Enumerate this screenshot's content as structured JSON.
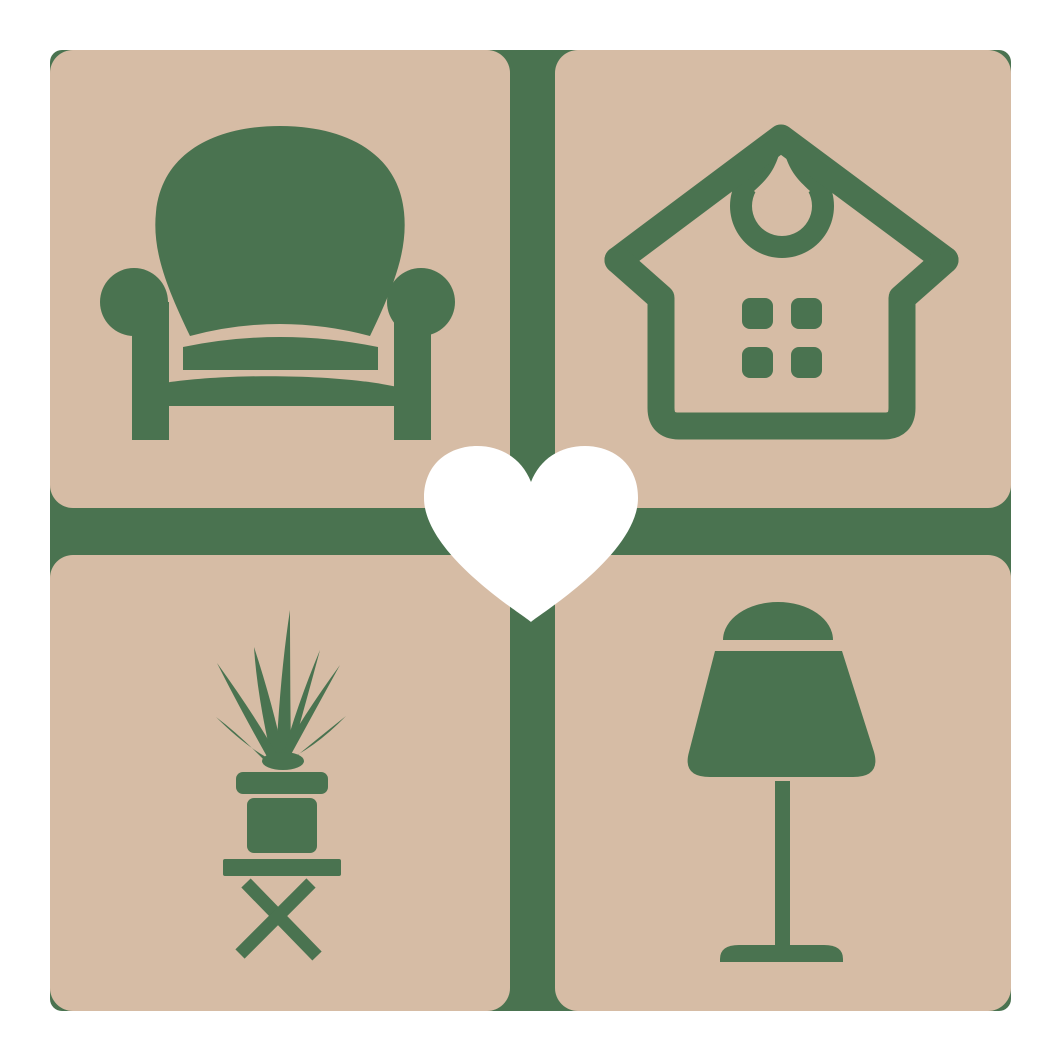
{
  "logo": {
    "name": "home-furnishings-love-logo",
    "description": "2x2 grid of rounded tan tiles with green furniture icons over a green backplate, white heart at center",
    "colors": {
      "background": "#ffffff",
      "backplate_green": "#4a7350",
      "tile_tan": "#d6bca5",
      "heart_white": "#ffffff"
    },
    "tiles": [
      {
        "position": "top-left",
        "icon": "armchair-icon"
      },
      {
        "position": "top-right",
        "icon": "house-icon"
      },
      {
        "position": "bottom-left",
        "icon": "potted-plant-icon"
      },
      {
        "position": "bottom-right",
        "icon": "table-lamp-icon"
      }
    ],
    "center_icon": "heart-icon"
  }
}
